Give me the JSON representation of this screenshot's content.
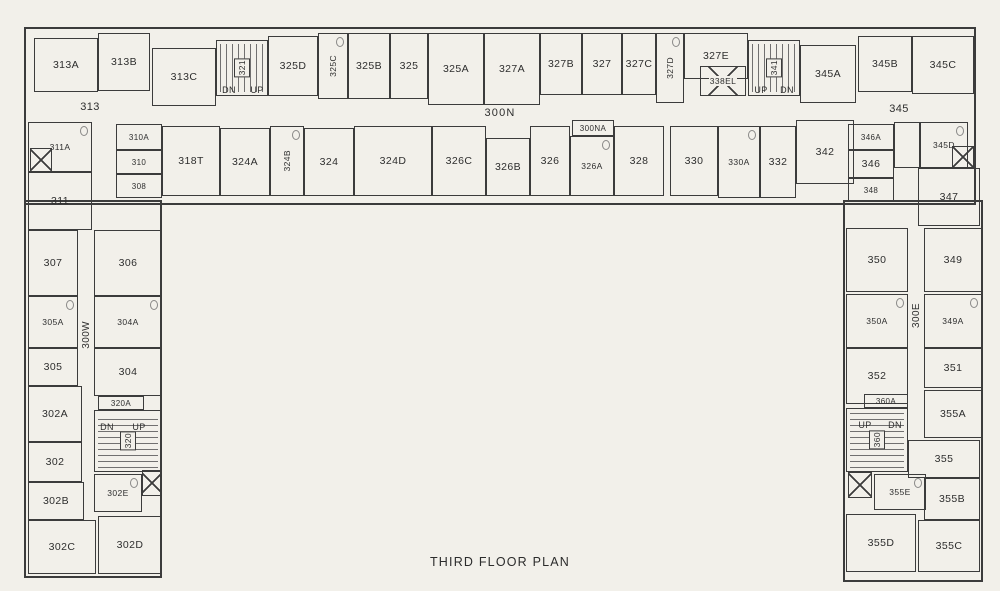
{
  "title": "THIRD FLOOR PLAN",
  "colors": {
    "paper": "#f2f0ea",
    "ink": "#3c3c3c"
  },
  "corridors": {
    "north": "300N",
    "west": "300W",
    "east": "300E"
  },
  "rooms": [
    {
      "label": "313A",
      "x": 34,
      "y": 38,
      "w": 64,
      "h": 54,
      "t": "room"
    },
    {
      "label": "313B",
      "x": 98,
      "y": 33,
      "w": 52,
      "h": 58,
      "t": "room"
    },
    {
      "label": "313C",
      "x": 152,
      "y": 48,
      "w": 64,
      "h": 58,
      "t": "room"
    },
    {
      "label": "321",
      "x": 216,
      "y": 40,
      "w": 52,
      "h": 56,
      "t": "stair",
      "v": true,
      "dir": "tv"
    },
    {
      "label": "DN",
      "x": 220,
      "y": 84,
      "w": 18,
      "h": 11,
      "t": "text"
    },
    {
      "label": "UP",
      "x": 248,
      "y": 84,
      "w": 18,
      "h": 11,
      "t": "text"
    },
    {
      "label": "325D",
      "x": 268,
      "y": 36,
      "w": 50,
      "h": 60,
      "t": "room"
    },
    {
      "label": "325C",
      "x": 318,
      "y": 33,
      "w": 30,
      "h": 66,
      "t": "bath",
      "v": true
    },
    {
      "label": "325B",
      "x": 348,
      "y": 33,
      "w": 42,
      "h": 66,
      "t": "room"
    },
    {
      "label": "325",
      "x": 390,
      "y": 33,
      "w": 38,
      "h": 66,
      "t": "room"
    },
    {
      "label": "325A",
      "x": 428,
      "y": 33,
      "w": 56,
      "h": 72,
      "t": "room"
    },
    {
      "label": "327A",
      "x": 484,
      "y": 33,
      "w": 56,
      "h": 72,
      "t": "room"
    },
    {
      "label": "327B",
      "x": 540,
      "y": 33,
      "w": 42,
      "h": 62,
      "t": "room"
    },
    {
      "label": "327",
      "x": 582,
      "y": 33,
      "w": 40,
      "h": 62,
      "t": "room"
    },
    {
      "label": "327C",
      "x": 622,
      "y": 33,
      "w": 34,
      "h": 62,
      "t": "room"
    },
    {
      "label": "327D",
      "x": 656,
      "y": 33,
      "w": 28,
      "h": 70,
      "t": "bath",
      "v": true
    },
    {
      "label": "327E",
      "x": 684,
      "y": 33,
      "w": 64,
      "h": 46,
      "t": "room"
    },
    {
      "label": "338EL",
      "x": 700,
      "y": 66,
      "w": 46,
      "h": 30,
      "t": "elev"
    },
    {
      "label": "341",
      "x": 748,
      "y": 40,
      "w": 52,
      "h": 56,
      "t": "stair",
      "v": true,
      "dir": "tv"
    },
    {
      "label": "UP",
      "x": 752,
      "y": 84,
      "w": 18,
      "h": 11,
      "t": "text"
    },
    {
      "label": "DN",
      "x": 778,
      "y": 84,
      "w": 18,
      "h": 11,
      "t": "text"
    },
    {
      "label": "345A",
      "x": 800,
      "y": 45,
      "w": 56,
      "h": 58,
      "t": "room"
    },
    {
      "label": "345B",
      "x": 858,
      "y": 36,
      "w": 54,
      "h": 56,
      "t": "room"
    },
    {
      "label": "345C",
      "x": 912,
      "y": 36,
      "w": 62,
      "h": 58,
      "t": "room"
    },
    {
      "label": "345",
      "x": 844,
      "y": 92,
      "w": 110,
      "h": 34,
      "t": "plain"
    },
    {
      "label": "313",
      "x": 30,
      "y": 90,
      "w": 120,
      "h": 34,
      "t": "plain"
    },
    {
      "label": "300N",
      "x": 300,
      "y": 100,
      "w": 400,
      "h": 26,
      "t": "corrh"
    },
    {
      "label": "310A",
      "x": 116,
      "y": 124,
      "w": 46,
      "h": 26,
      "t": "small"
    },
    {
      "label": "310",
      "x": 116,
      "y": 150,
      "w": 46,
      "h": 24,
      "t": "small"
    },
    {
      "label": "308",
      "x": 116,
      "y": 174,
      "w": 46,
      "h": 24,
      "t": "small"
    },
    {
      "label": "318T",
      "x": 162,
      "y": 126,
      "w": 58,
      "h": 70,
      "t": "room"
    },
    {
      "label": "324A",
      "x": 220,
      "y": 128,
      "w": 50,
      "h": 68,
      "t": "room"
    },
    {
      "label": "324B",
      "x": 270,
      "y": 126,
      "w": 34,
      "h": 70,
      "t": "bath",
      "v": true
    },
    {
      "label": "324",
      "x": 304,
      "y": 128,
      "w": 50,
      "h": 68,
      "t": "room"
    },
    {
      "label": "324D",
      "x": 354,
      "y": 126,
      "w": 78,
      "h": 70,
      "t": "room"
    },
    {
      "label": "326C",
      "x": 432,
      "y": 126,
      "w": 54,
      "h": 70,
      "t": "room"
    },
    {
      "label": "326B",
      "x": 486,
      "y": 138,
      "w": 44,
      "h": 58,
      "t": "room"
    },
    {
      "label": "326",
      "x": 530,
      "y": 126,
      "w": 40,
      "h": 70,
      "t": "room"
    },
    {
      "label": "300NA",
      "x": 572,
      "y": 120,
      "w": 42,
      "h": 16,
      "t": "small"
    },
    {
      "label": "326A",
      "x": 570,
      "y": 136,
      "w": 44,
      "h": 60,
      "t": "bath"
    },
    {
      "label": "328",
      "x": 614,
      "y": 126,
      "w": 50,
      "h": 70,
      "t": "room"
    },
    {
      "label": "330",
      "x": 670,
      "y": 126,
      "w": 48,
      "h": 70,
      "t": "room"
    },
    {
      "label": "330A",
      "x": 718,
      "y": 126,
      "w": 42,
      "h": 72,
      "t": "bath"
    },
    {
      "label": "332",
      "x": 760,
      "y": 126,
      "w": 36,
      "h": 72,
      "t": "room"
    },
    {
      "label": "342",
      "x": 796,
      "y": 120,
      "w": 58,
      "h": 64,
      "t": "room"
    },
    {
      "label": "346A",
      "x": 848,
      "y": 124,
      "w": 46,
      "h": 26,
      "t": "small"
    },
    {
      "label": "346",
      "x": 848,
      "y": 150,
      "w": 46,
      "h": 28,
      "t": "room"
    },
    {
      "label": "348",
      "x": 848,
      "y": 178,
      "w": 46,
      "h": 24,
      "t": "small"
    },
    {
      "label": "",
      "x": 894,
      "y": 122,
      "w": 26,
      "h": 46,
      "t": "room"
    },
    {
      "label": "345D",
      "x": 920,
      "y": 122,
      "w": 48,
      "h": 46,
      "t": "bath"
    },
    {
      "label": "",
      "x": 952,
      "y": 146,
      "w": 22,
      "h": 22,
      "t": "elev"
    },
    {
      "label": "347",
      "x": 918,
      "y": 168,
      "w": 62,
      "h": 58,
      "t": "room"
    },
    {
      "label": "311A",
      "x": 28,
      "y": 122,
      "w": 64,
      "h": 50,
      "t": "bath"
    },
    {
      "label": "",
      "x": 30,
      "y": 148,
      "w": 22,
      "h": 24,
      "t": "elev"
    },
    {
      "label": "311",
      "x": 28,
      "y": 172,
      "w": 64,
      "h": 58,
      "t": "room"
    },
    {
      "label": "307",
      "x": 28,
      "y": 230,
      "w": 50,
      "h": 66,
      "t": "room"
    },
    {
      "label": "306",
      "x": 94,
      "y": 230,
      "w": 68,
      "h": 66,
      "t": "room"
    },
    {
      "label": "300W",
      "x": 78,
      "y": 300,
      "w": 16,
      "h": 70,
      "t": "corrv"
    },
    {
      "label": "305A",
      "x": 28,
      "y": 296,
      "w": 50,
      "h": 52,
      "t": "bath"
    },
    {
      "label": "304A",
      "x": 94,
      "y": 296,
      "w": 68,
      "h": 52,
      "t": "bath"
    },
    {
      "label": "305",
      "x": 28,
      "y": 348,
      "w": 50,
      "h": 38,
      "t": "room"
    },
    {
      "label": "304",
      "x": 94,
      "y": 348,
      "w": 68,
      "h": 48,
      "t": "room"
    },
    {
      "label": "302A",
      "x": 28,
      "y": 386,
      "w": 54,
      "h": 56,
      "t": "room"
    },
    {
      "label": "320A",
      "x": 98,
      "y": 396,
      "w": 46,
      "h": 14,
      "t": "small"
    },
    {
      "label": "320",
      "x": 94,
      "y": 410,
      "w": 68,
      "h": 62,
      "t": "stair",
      "v": true,
      "dir": "th"
    },
    {
      "label": "DN",
      "x": 98,
      "y": 421,
      "w": 18,
      "h": 11,
      "t": "text"
    },
    {
      "label": "UP",
      "x": 130,
      "y": 421,
      "w": 18,
      "h": 11,
      "t": "text"
    },
    {
      "label": "302",
      "x": 28,
      "y": 442,
      "w": 54,
      "h": 40,
      "t": "room"
    },
    {
      "label": "302B",
      "x": 28,
      "y": 482,
      "w": 56,
      "h": 38,
      "t": "room"
    },
    {
      "label": "302E",
      "x": 94,
      "y": 474,
      "w": 48,
      "h": 38,
      "t": "bath"
    },
    {
      "label": "",
      "x": 142,
      "y": 470,
      "w": 20,
      "h": 26,
      "t": "elev"
    },
    {
      "label": "302C",
      "x": 28,
      "y": 520,
      "w": 68,
      "h": 54,
      "t": "room"
    },
    {
      "label": "302D",
      "x": 98,
      "y": 516,
      "w": 64,
      "h": 58,
      "t": "room"
    },
    {
      "label": "350",
      "x": 846,
      "y": 228,
      "w": 62,
      "h": 64,
      "t": "room"
    },
    {
      "label": "349",
      "x": 924,
      "y": 228,
      "w": 58,
      "h": 64,
      "t": "room"
    },
    {
      "label": "300E",
      "x": 908,
      "y": 280,
      "w": 16,
      "h": 70,
      "t": "corrv"
    },
    {
      "label": "350A",
      "x": 846,
      "y": 294,
      "w": 62,
      "h": 54,
      "t": "bath"
    },
    {
      "label": "349A",
      "x": 924,
      "y": 294,
      "w": 58,
      "h": 54,
      "t": "bath"
    },
    {
      "label": "352",
      "x": 846,
      "y": 348,
      "w": 62,
      "h": 56,
      "t": "room"
    },
    {
      "label": "351",
      "x": 924,
      "y": 348,
      "w": 58,
      "h": 40,
      "t": "room"
    },
    {
      "label": "355A",
      "x": 924,
      "y": 390,
      "w": 58,
      "h": 48,
      "t": "room"
    },
    {
      "label": "360A",
      "x": 864,
      "y": 394,
      "w": 44,
      "h": 14,
      "t": "small"
    },
    {
      "label": "360",
      "x": 846,
      "y": 408,
      "w": 62,
      "h": 64,
      "t": "stair",
      "v": true,
      "dir": "th"
    },
    {
      "label": "UP",
      "x": 856,
      "y": 419,
      "w": 18,
      "h": 11,
      "t": "text"
    },
    {
      "label": "DN",
      "x": 886,
      "y": 419,
      "w": 18,
      "h": 11,
      "t": "text"
    },
    {
      "label": "355",
      "x": 908,
      "y": 440,
      "w": 72,
      "h": 38,
      "t": "room"
    },
    {
      "label": "",
      "x": 848,
      "y": 472,
      "w": 24,
      "h": 26,
      "t": "elev"
    },
    {
      "label": "355E",
      "x": 874,
      "y": 474,
      "w": 52,
      "h": 36,
      "t": "bath"
    },
    {
      "label": "355B",
      "x": 924,
      "y": 478,
      "w": 56,
      "h": 42,
      "t": "room"
    },
    {
      "label": "355D",
      "x": 846,
      "y": 514,
      "w": 70,
      "h": 58,
      "t": "room"
    },
    {
      "label": "355C",
      "x": 918,
      "y": 520,
      "w": 62,
      "h": 52,
      "t": "room"
    }
  ]
}
